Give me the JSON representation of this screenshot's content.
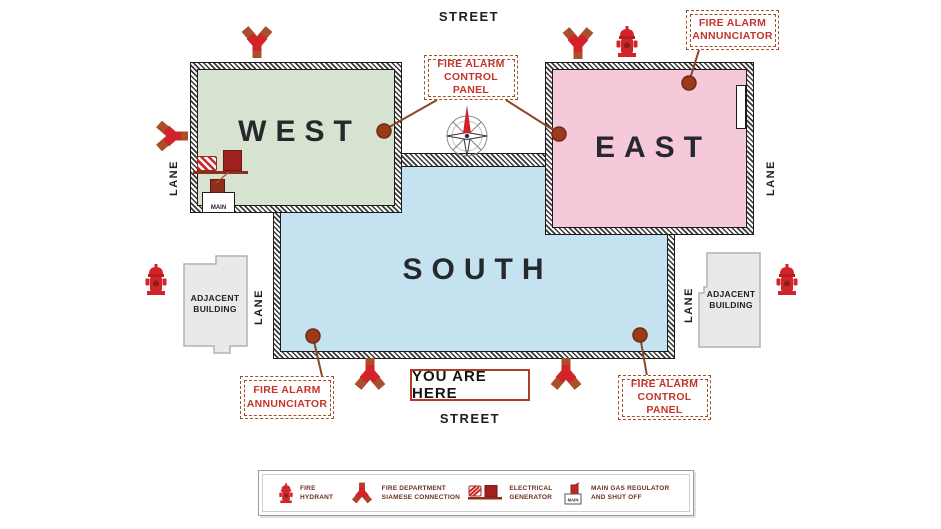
{
  "map": {
    "street_top": "STREET",
    "street_bottom": "STREET",
    "lanes": [
      "LANE",
      "LANE",
      "LANE",
      "LANE"
    ],
    "buildings": [
      {
        "id": "west",
        "label": "WEST",
        "fill": "#d7e3d1"
      },
      {
        "id": "east",
        "label": "EAST",
        "fill": "#f5c9da"
      },
      {
        "id": "south",
        "label": "SOUTH",
        "fill": "#c5e2f1"
      }
    ],
    "adjacent": [
      {
        "label": "ADJACENT BUILDING"
      },
      {
        "label": "ADJACENT BUILDING"
      }
    ],
    "tags": [
      {
        "id": "control-panel-top",
        "label": "FIRE ALARM CONTROL PANEL"
      },
      {
        "id": "annunciator-top-right",
        "label": "FIRE ALARM ANNUNCIATOR"
      },
      {
        "id": "annunciator-bottom-left",
        "label": "FIRE ALARM ANNUNCIATOR"
      },
      {
        "id": "control-panel-bottom-right",
        "label": "FIRE ALARM CONTROL PANEL"
      }
    ],
    "you_are_here": "YOU ARE HERE",
    "main_gas_label": "MAIN",
    "icons": {
      "hydrant": "fire-hydrant-icon",
      "siamese": "siamese-connection-icon",
      "generator": "electrical-generator-icon",
      "gas_regulator": "main-gas-regulator-icon",
      "compass": "compass-rose-icon"
    }
  },
  "legend": {
    "main_text": "MAIN",
    "items": [
      {
        "icon": "fire-hydrant-icon",
        "label": "FIRE HYDRANT"
      },
      {
        "icon": "siamese-connection-icon",
        "label": "FIRE DEPARTMENT SIAMESE CONNECTION"
      },
      {
        "icon": "electrical-generator-icon",
        "label": "ELECTRICAL GENERATOR"
      },
      {
        "icon": "main-gas-regulator-icon",
        "label": "MAIN GAS REGULATOR AND SHUT OFF"
      }
    ]
  },
  "colors": {
    "icon_red": "#d3232a",
    "connector_brown": "#8d4526",
    "dot_fill": "#9c3a1c",
    "tag_text": "#c4342b",
    "tag_border": "#a1512c",
    "west_fill": "#d7e3d1",
    "east_fill": "#f5c9da",
    "south_fill": "#c5e2f1",
    "adjacent_fill": "#e9e9e9",
    "legend_text": "#6e2f1f",
    "title_text": "#26282b"
  }
}
